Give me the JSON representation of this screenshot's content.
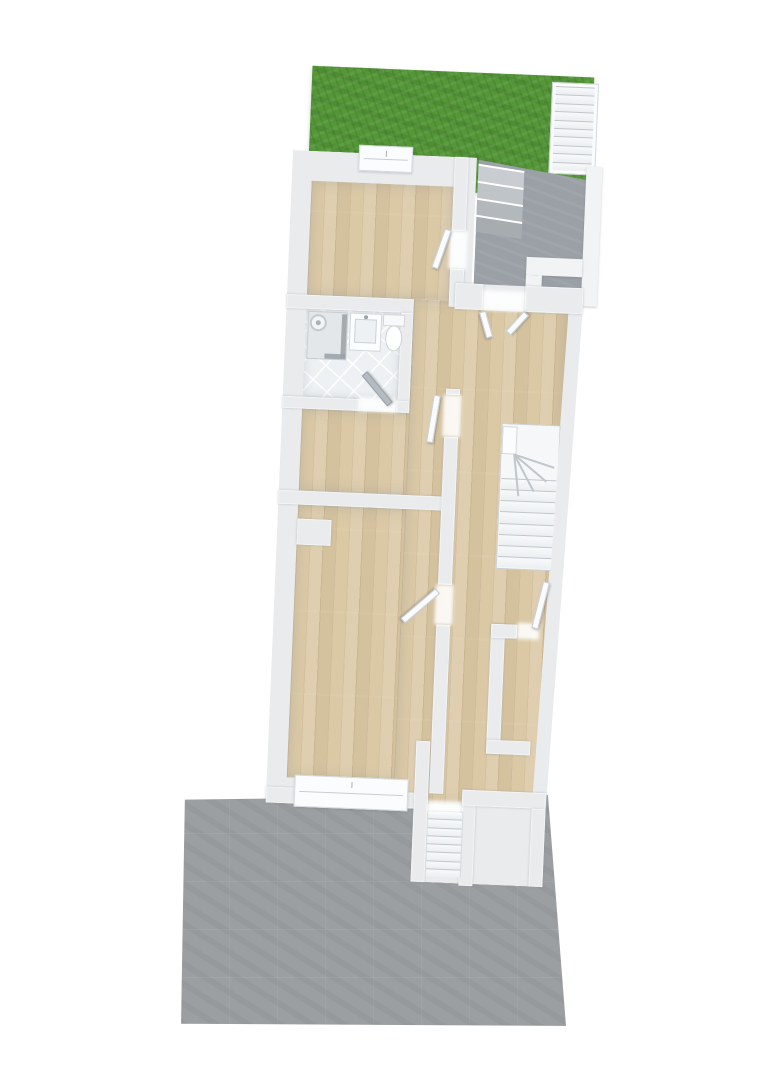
{
  "scene": {
    "kind": "3d-floor-plan-render",
    "background": "#ffffff",
    "rotation_deg": 2.4
  },
  "palette": {
    "bg": "#ffffff",
    "grass": "#559638",
    "wood": "#dbc9a6",
    "wall": "#e9ebed",
    "wall_bright": "#f1f3f5",
    "tile": "#eef1f3",
    "court": "#9aa0a5",
    "terrace": "#9c9fa2",
    "tread": "#f4f6f7",
    "tread_edge": "#c0c6cb",
    "glass": "#99a1a8"
  },
  "areas": {
    "garden": "lawn",
    "entry_courtyard": "concrete",
    "terrace": "paved",
    "bathroom": "tiled",
    "rooms": [
      "top-room",
      "middle-room",
      "large-room",
      "small-room",
      "hallway"
    ]
  },
  "fixtures": [
    "shower",
    "shower-head",
    "vanity-sink",
    "toilet"
  ],
  "stairs": {
    "garden": {
      "treads": 10
    },
    "courtyard": {
      "step_colors": [
        "#c9cdd1",
        "#bfc4c8",
        "#b3b8bd",
        "#a7acb1"
      ]
    },
    "winder": {
      "straight_treads": 8,
      "fan_angles": [
        16,
        38,
        60,
        82
      ]
    },
    "exterior": {
      "treads": 8
    }
  },
  "doors": {
    "front": "double-inswing",
    "interior_leaves": 6
  },
  "windows": {
    "top": 1,
    "bottom": 1
  }
}
